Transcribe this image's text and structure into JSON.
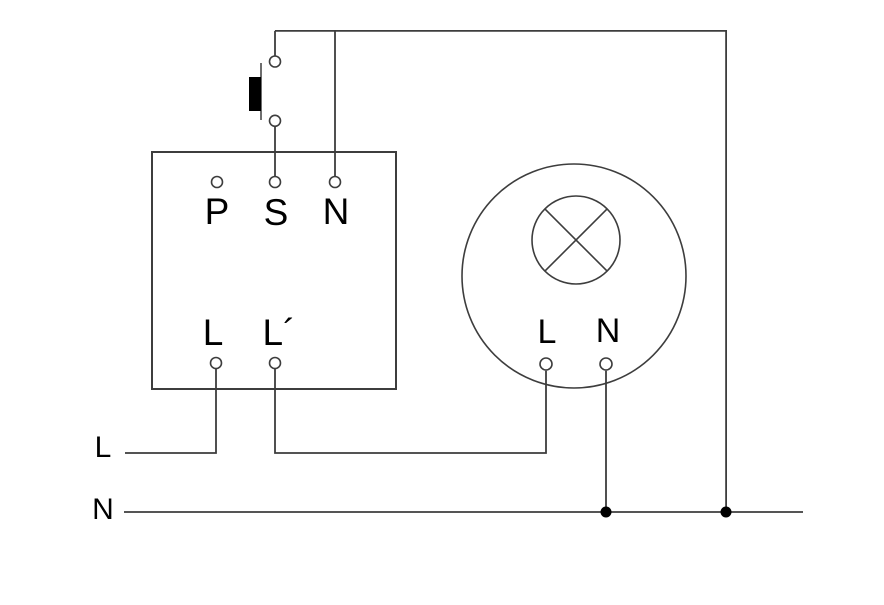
{
  "diagram": {
    "background_color": "#ffffff",
    "line_color": "#3d3d3d",
    "text_color": "#000000",
    "device": {
      "terminal_p": "P",
      "terminal_s": "S",
      "terminal_n": "N",
      "terminal_l": "L",
      "terminal_l_switched": "L´"
    },
    "lamp": {
      "terminal_l": "L",
      "terminal_n": "N"
    },
    "supply": {
      "live": "L",
      "neutral": "N"
    }
  }
}
